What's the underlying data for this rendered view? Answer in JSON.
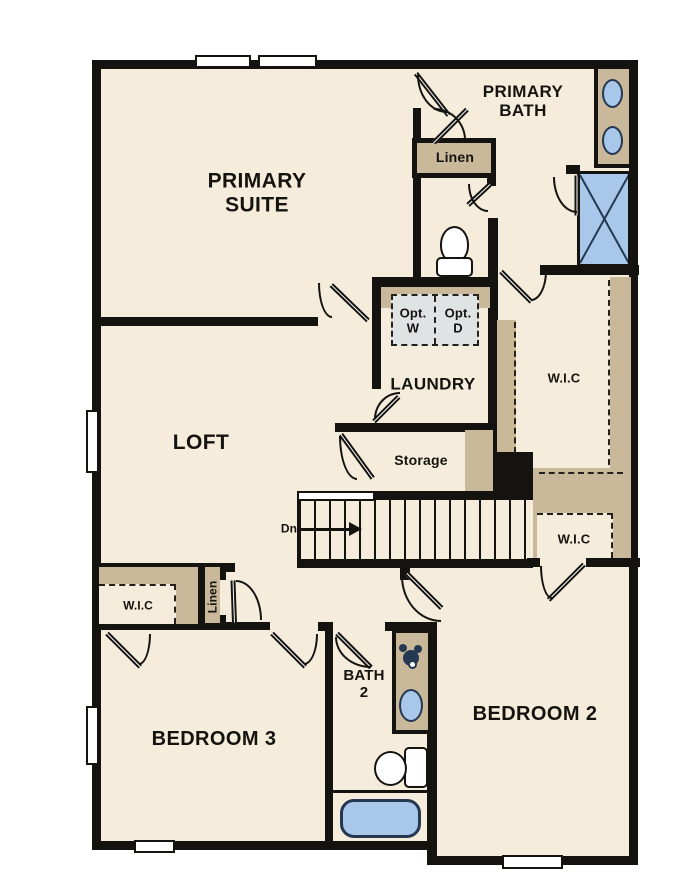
{
  "plan": {
    "title": "second-floor-plan",
    "labels": {
      "primary_suite": "PRIMARY\nSUITE",
      "primary_bath": "PRIMARY\nBATH",
      "linen_upper": "Linen",
      "laundry": "LAUNDRY",
      "opt_washer": "Opt.\nW",
      "opt_dryer": "Opt.\nD",
      "wic_primary": "W.I.C",
      "loft": "LOFT",
      "storage": "Storage",
      "stairs_down": "Dn",
      "wic_hall": "W.I.C",
      "wic_bedroom3": "W.I.C",
      "linen_lower": "Linen",
      "bedroom3": "BEDROOM 3",
      "bath2": "BATH\n2",
      "bedroom2": "BEDROOM 2"
    },
    "colors": {
      "floor": "#f5ecdb",
      "wall": "#151310",
      "cabinet_tan": "#c9b89a",
      "fixture_blue": "#a9c8e9",
      "fixture_outline": "#253852",
      "appliance_gray": "#e0e3e3"
    }
  }
}
